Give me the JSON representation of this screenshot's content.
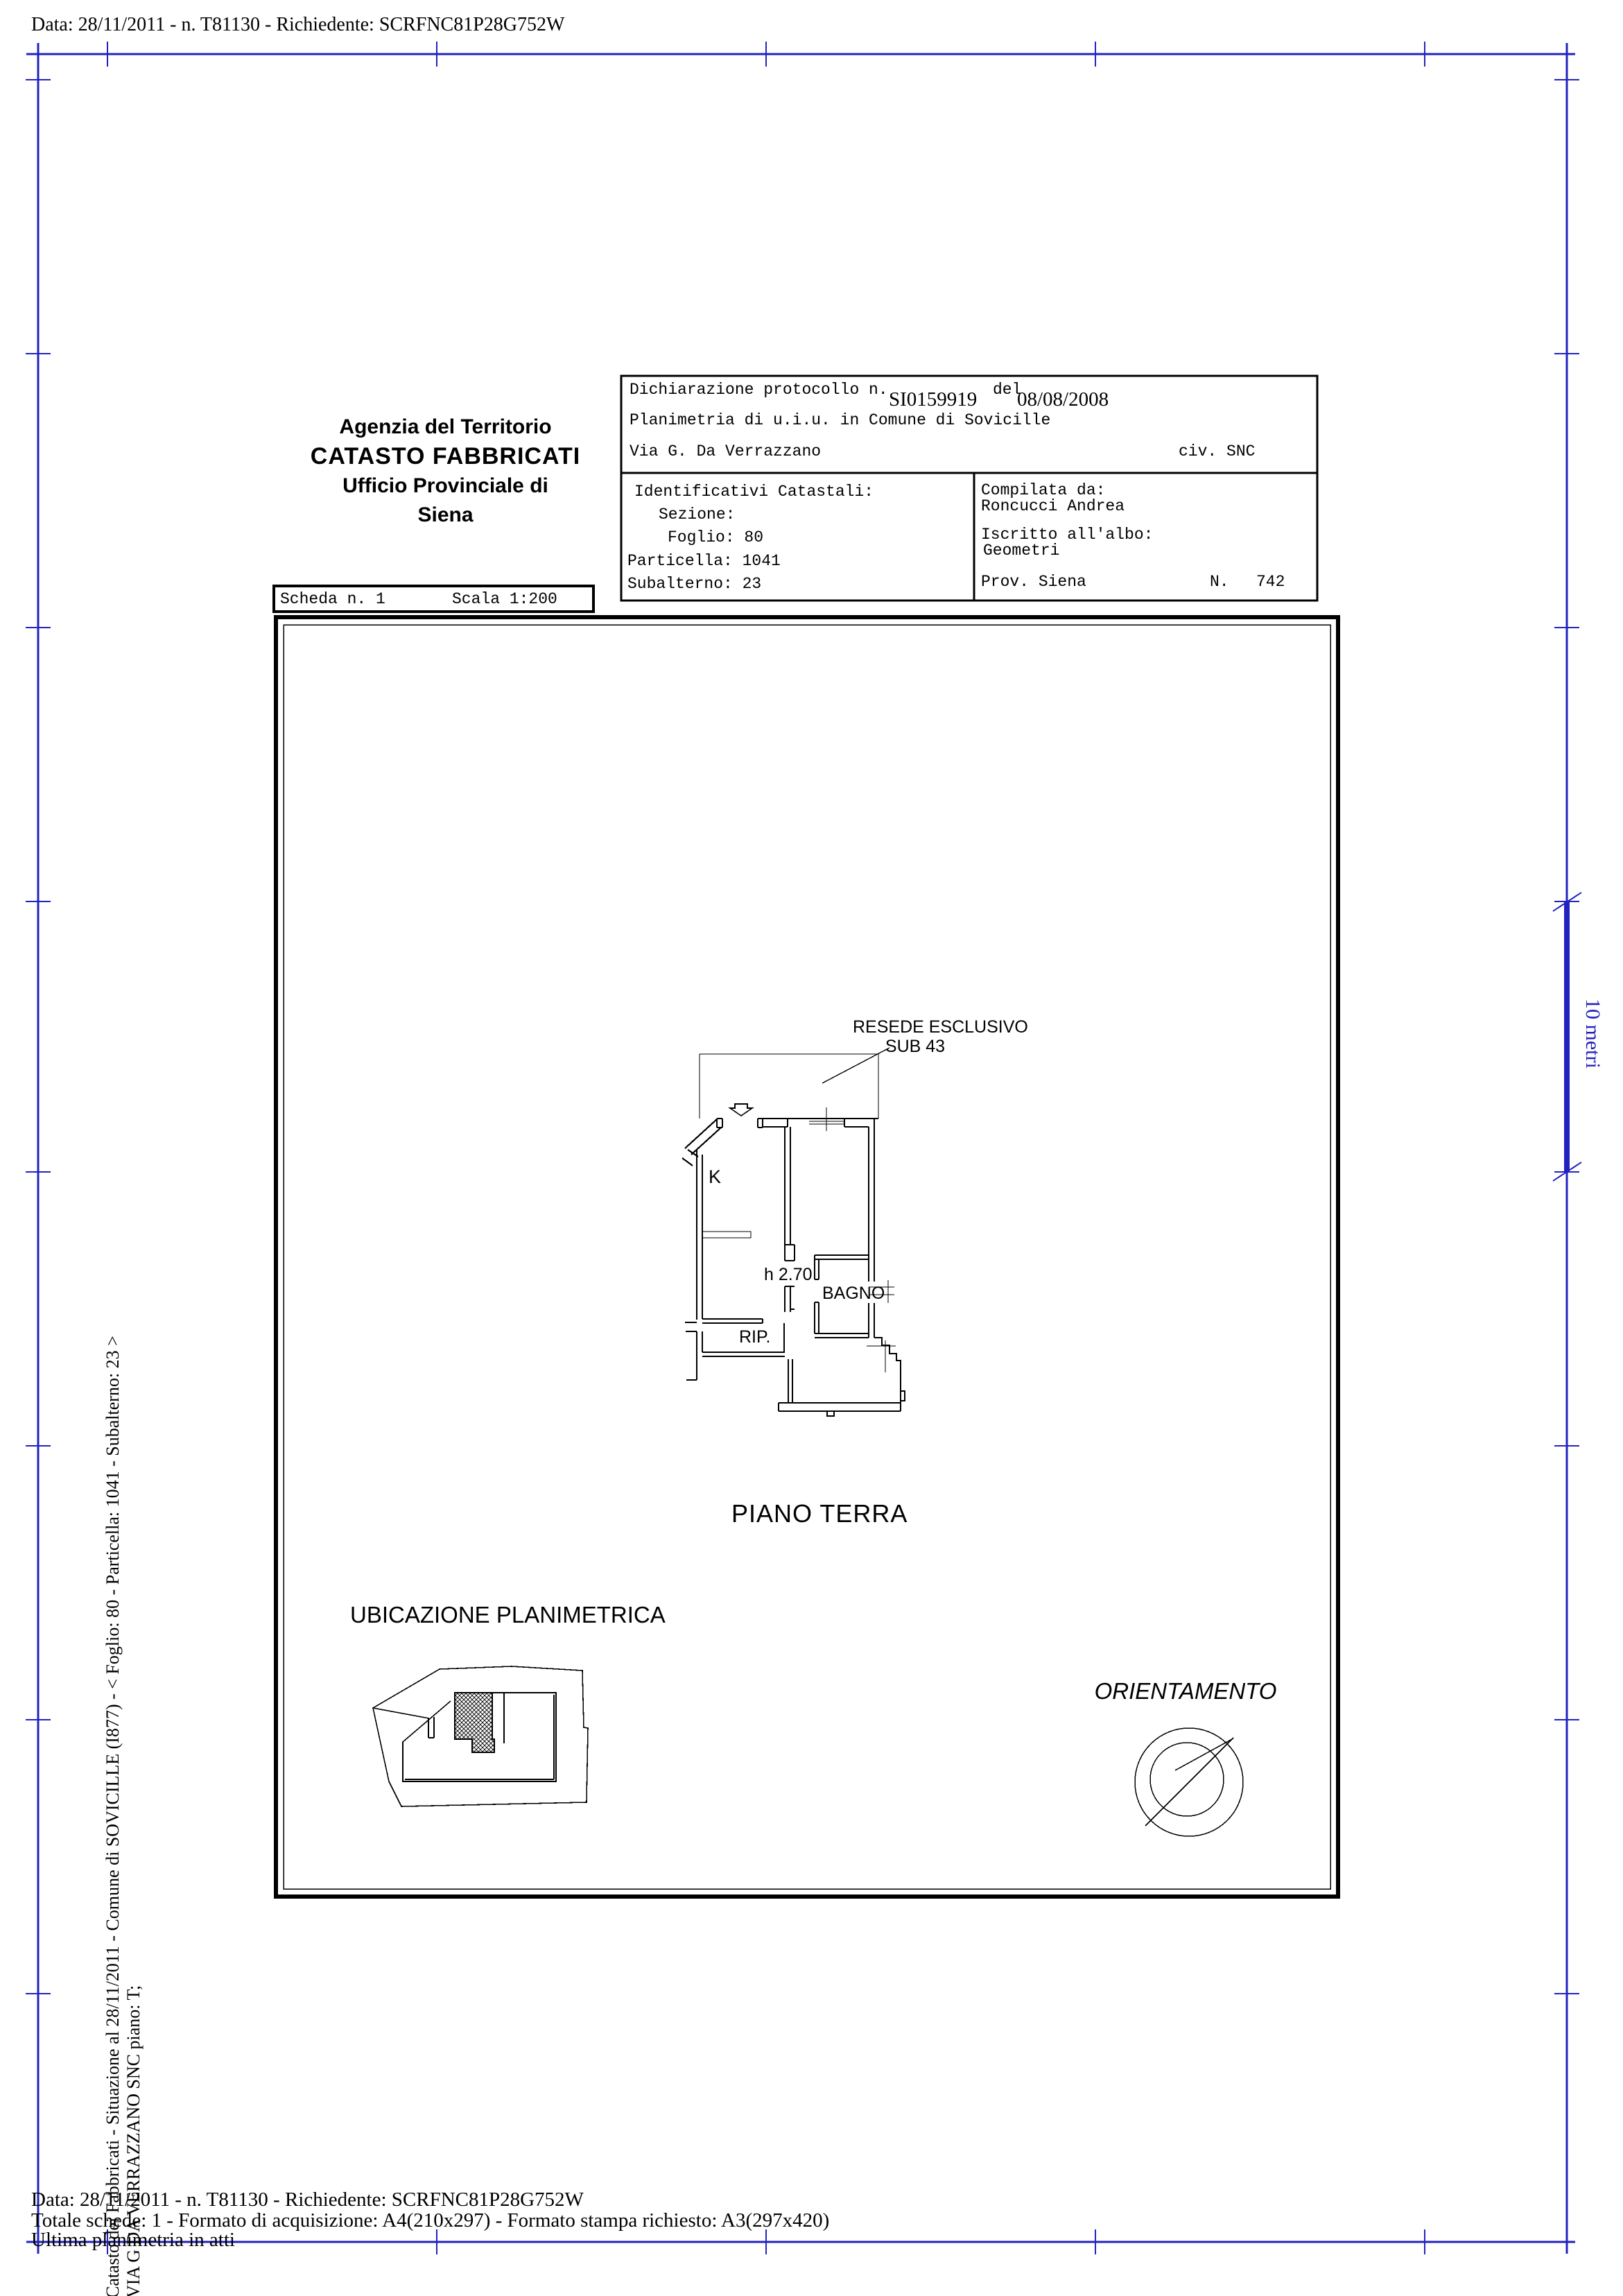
{
  "colors": {
    "border_blue": "#2222c0",
    "line_black": "#000000"
  },
  "page": {
    "top_line": "Data: 28/11/2011 - n. T81130 - Richiedente: SCRFNC81P28G752W",
    "bottom_line1": "Data: 28/11/2011 - n. T81130 - Richiedente: SCRFNC81P28G752W",
    "bottom_line2": "Totale schede: 1 - Formato di acquisizione: A4(210x297)  - Formato stampa richiesto: A3(297x420)",
    "bottom_line3": "Ultima planimetria in atti",
    "left_vertical_line1": "Catasto dei Fabbricati - Situazione al 28/11/2011 - Comune di SOVICILLE (I877) - < Foglio: 80 - Particella: 1041 - Subalterno: 23 >",
    "left_vertical_line2": "VIA G DA VERRAZZANO SNC piano: T;",
    "scale_bar_label": "10 metri"
  },
  "header": {
    "agency": "Agenzia del Territorio",
    "registry": "CATASTO FABBRICATI",
    "office": "Ufficio Provinciale di",
    "city": "Siena"
  },
  "sheet": {
    "scheda": "Scheda n. 1",
    "scala": "Scala 1:200"
  },
  "declaration": {
    "protocol_label": "Dichiarazione protocollo n.",
    "protocol_number": "SI0159919",
    "del_label": "del",
    "protocol_date": "08/08/2008",
    "planimetria_line": "Planimetria di u.i.u. in Comune di Sovicille",
    "street": "Via G. Da Verrazzano",
    "civic": "civ. SNC"
  },
  "cadastral": {
    "title": "Identificativi Catastali:",
    "sezione": "Sezione:",
    "foglio": "Foglio: 80",
    "particella": "Particella: 1041",
    "subalterno": "Subalterno: 23"
  },
  "compiler": {
    "label": "Compilata da:",
    "name": "Roncucci Andrea",
    "albo_label": "Iscritto all'albo:",
    "albo": "Geometri",
    "prov": "Prov. Siena",
    "n_label": "N.",
    "n_value": "742"
  },
  "plan": {
    "resede": "RESEDE ESCLUSIVO",
    "sub": "SUB 43",
    "room_k": "K",
    "height_note": "h 2.70",
    "bagno": "BAGNO",
    "rip": "RIP.",
    "floor": "PIANO TERRA",
    "ubicazione": "UBICAZIONE PLANIMETRICA",
    "orientamento": "ORIENTAMENTO"
  }
}
